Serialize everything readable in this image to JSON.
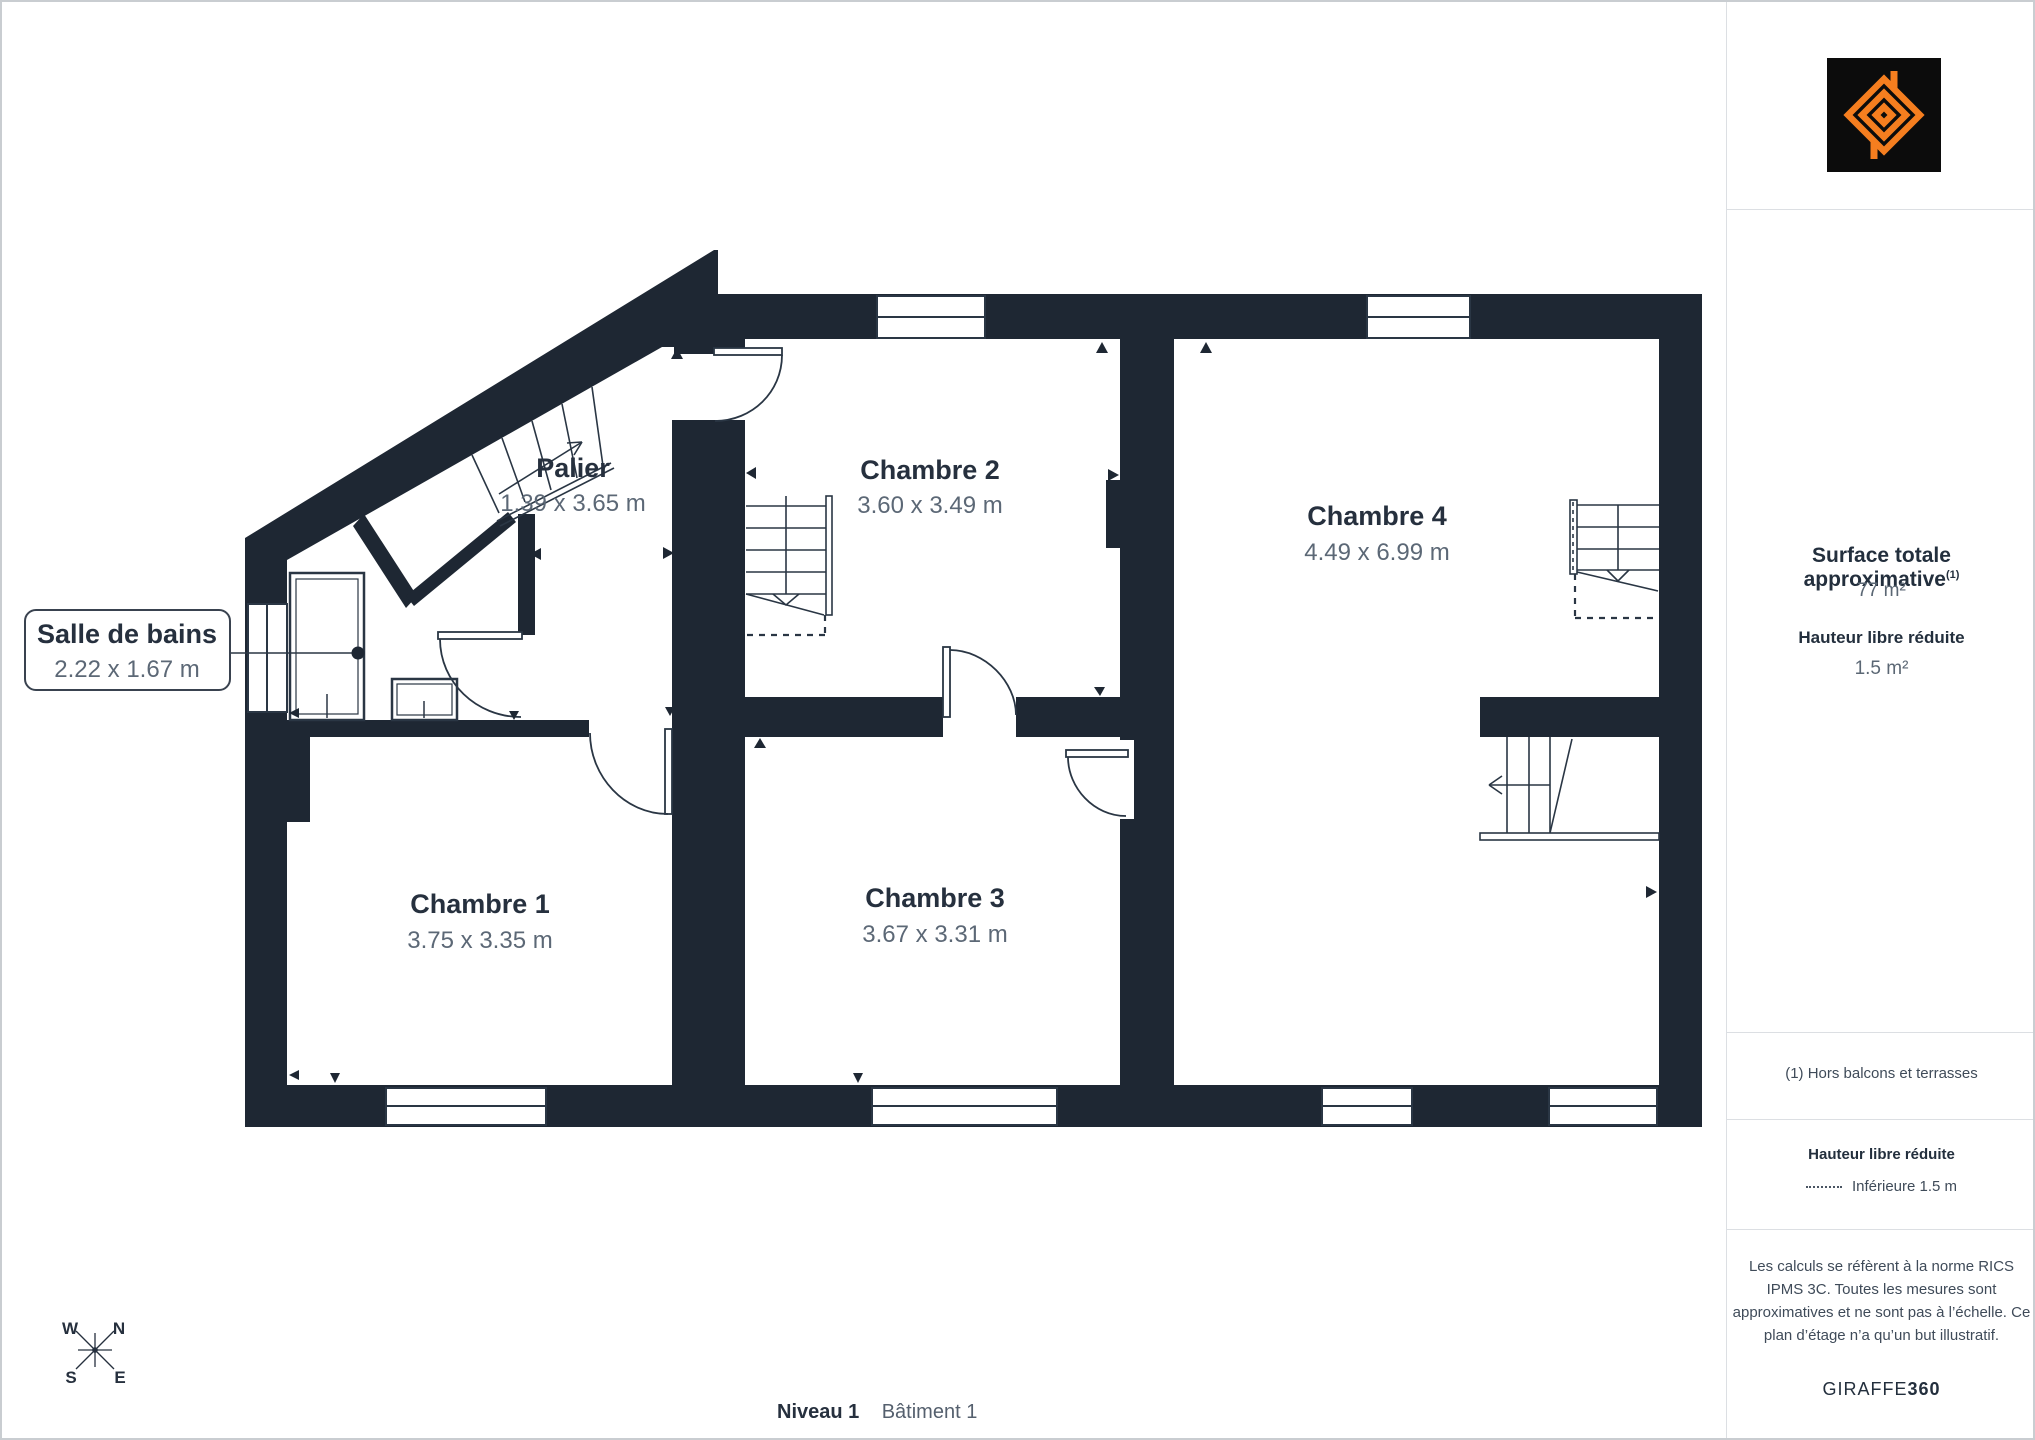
{
  "page": {
    "background": "#FFFFFF",
    "border_color": "#C9CDD1"
  },
  "branding": {
    "logo_icon": "giraffe360-mark-icon",
    "logo_bg": "#0C0C0C",
    "logo_accent": "#F57E1F",
    "brand_name": "GIRAFFE",
    "brand_suffix": "360"
  },
  "sidebar": {
    "surface_title": "Surface totale approximative",
    "surface_footnote_marker": "(1)",
    "surface_value": "77 m²",
    "reduced_height_title": "Hauteur libre réduite",
    "reduced_height_value": "1.5 m²",
    "footnote": "(1) Hors balcons et terrasses",
    "legend_title": "Hauteur libre réduite",
    "legend_dotted_label": "Inférieure 1.5 m",
    "disclaimer": "Les calculs se réfèrent à la norme RICS IPMS 3C. Toutes les mesures sont approximatives et ne sont pas à l’échelle. Ce plan d’étage n’a qu’un but illustratif."
  },
  "footer": {
    "level": "Niveau 1",
    "building": "Bâtiment 1"
  },
  "compass": {
    "w": "W",
    "n": "N",
    "s": "S",
    "e": "E"
  },
  "rooms": {
    "palier": {
      "name": "Palier",
      "dims": "1.39 x 3.65 m"
    },
    "chambre1": {
      "name": "Chambre 1",
      "dims": "3.75 x 3.35 m"
    },
    "chambre2": {
      "name": "Chambre 2",
      "dims": "3.60 x 3.49 m"
    },
    "chambre3": {
      "name": "Chambre 3",
      "dims": "3.67 x 3.31 m"
    },
    "chambre4": {
      "name": "Chambre 4",
      "dims": "4.49 x 6.99 m"
    },
    "salle_de_bains": {
      "name": "Salle de bains",
      "dims": "2.22 x 1.67 m"
    }
  },
  "colors": {
    "wall": "#1E2733",
    "label": "#26303E",
    "dims_text": "#5C6876",
    "thin_line": "#2A3644",
    "divider": "#DCDFE3",
    "accent_orange": "#F57E1F"
  }
}
